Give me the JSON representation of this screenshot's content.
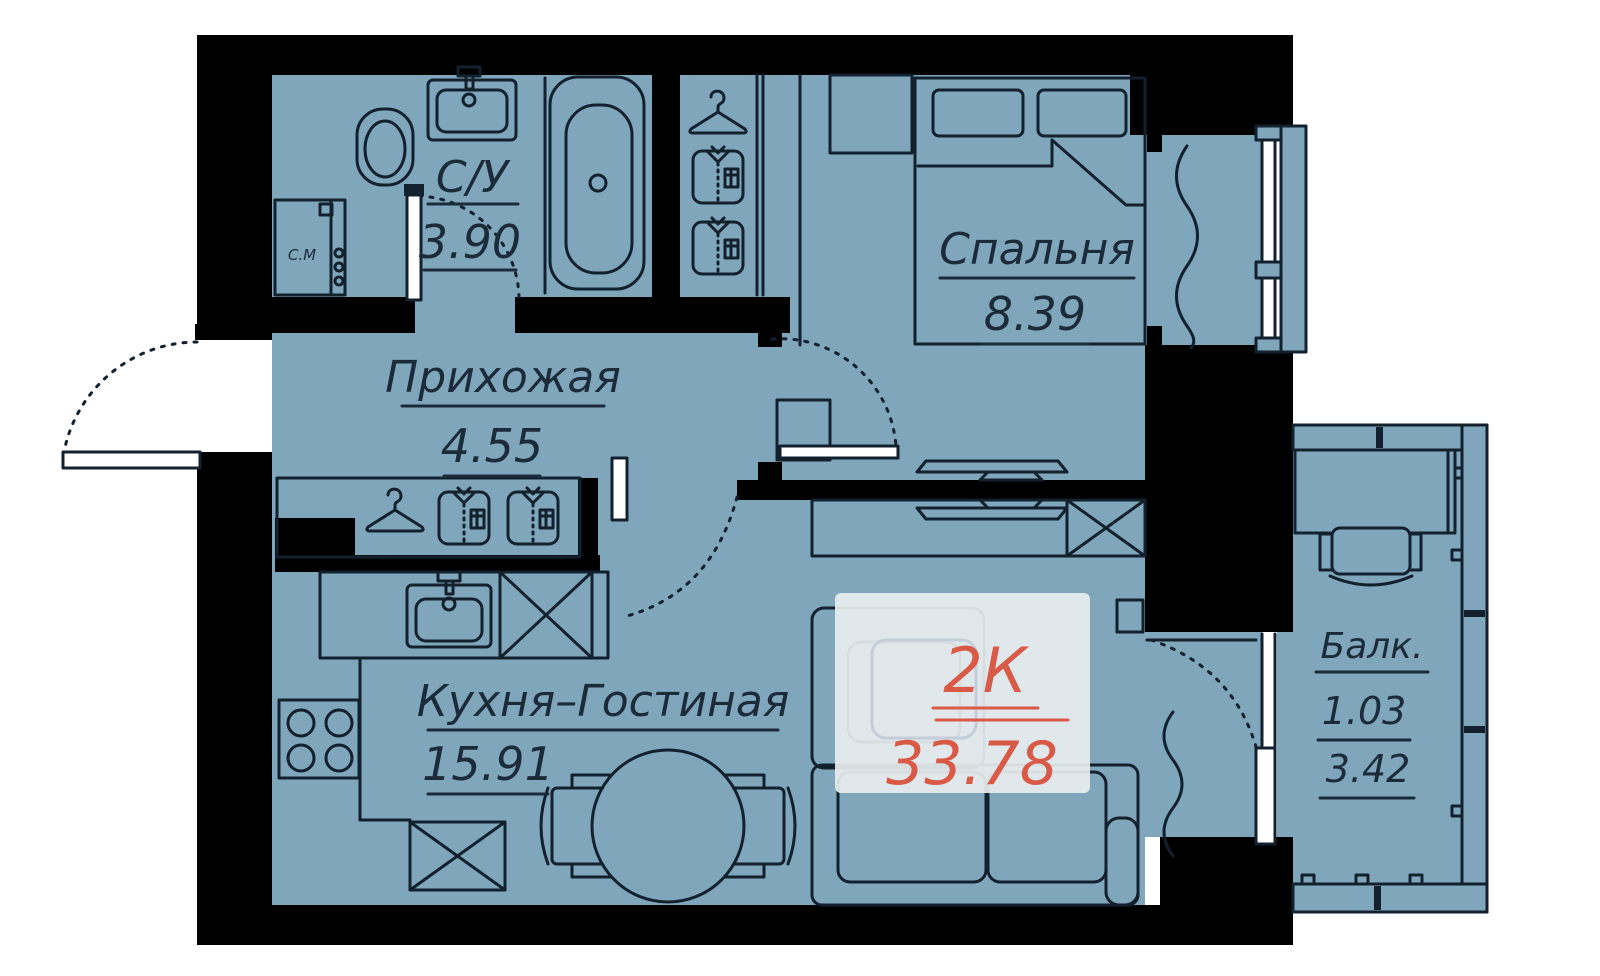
{
  "apartment": {
    "type": "2К",
    "total_area": "33.78"
  },
  "rooms": {
    "bathroom": {
      "name": "С/У",
      "area": "3.90"
    },
    "hallway": {
      "name": "Прихожая",
      "area": "4.55"
    },
    "bedroom": {
      "name": "Спальня",
      "area": "8.39"
    },
    "kitchen_living": {
      "name": "Кухня–Гостиная",
      "area": "15.91"
    },
    "balcony": {
      "name": "Балк.",
      "coef": "1.03",
      "area": "3.42"
    }
  },
  "labels": {
    "washing_machine": "С.М"
  },
  "colors": {
    "floor": "#7FA6BB",
    "wall": "#000000",
    "line": "#13212F",
    "text": "#1B2B3A",
    "accent": "#D95A47",
    "badge": "#E9EEF0",
    "background": "#FFFFFF"
  },
  "icons": {
    "toilet-icon": "svg-shape",
    "sink-icon": "svg-shape",
    "bathtub-icon": "svg-shape",
    "washing-machine-icon": "svg-shape",
    "hanger-icon": "svg-shape",
    "shirt-icon": "svg-shape",
    "bed-icon": "svg-shape",
    "nightstand-icon": "svg-shape",
    "tv-icon": "svg-shape",
    "cabinet-x-icon": "svg-shape",
    "stove-icon": "svg-shape",
    "dining-table-icon": "svg-shape",
    "chair-icon": "svg-shape",
    "sofa-icon": "svg-shape",
    "desk-icon": "svg-shape",
    "door-arc-icon": "svg-shape",
    "window-icon": "svg-shape",
    "radiator-icon": "svg-shape",
    "curtain-icon": "svg-shape"
  }
}
